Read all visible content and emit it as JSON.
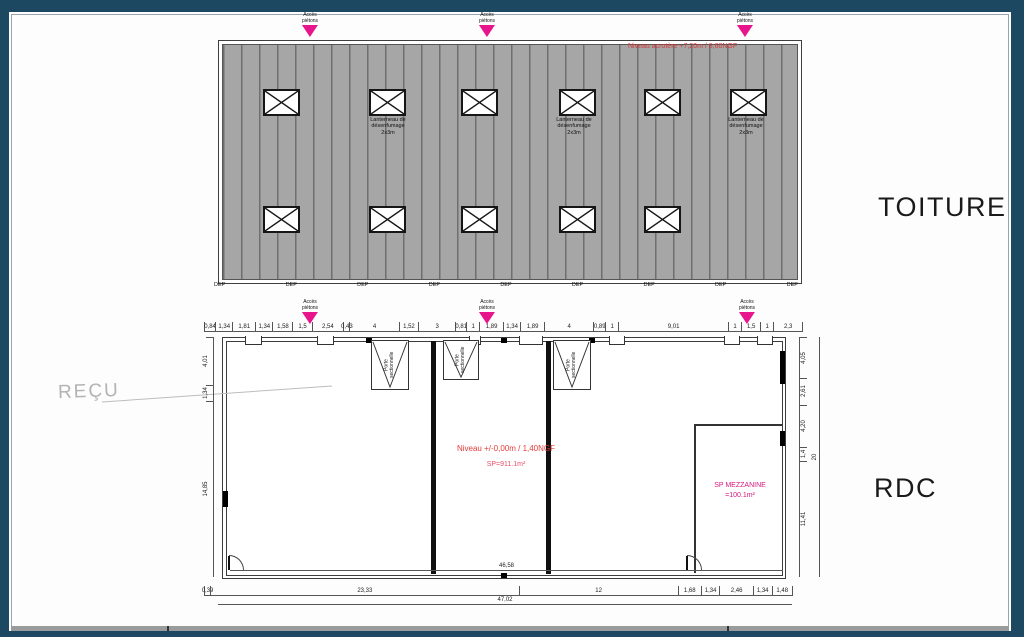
{
  "labels": {
    "toiture": "TOITURE",
    "rdc": "RDC",
    "watermark": "REÇU"
  },
  "roof": {
    "acroterre_note": "Niveau acrotère +7,20m / 8,60NGF",
    "skylight_label": "Lanterneau de\ndésenfumage\n2x3m",
    "dep_labels": [
      "DEP",
      "DEP",
      "DEP",
      "DEP",
      "DEP",
      "DEP",
      "DEP",
      "DEP",
      "DEP"
    ],
    "access_label": "Accès\npiétons"
  },
  "rdc": {
    "level_note": "Niveau +/-0,00m / 1,40NGF",
    "surface_note": "SP=911.1m²",
    "mezzanine_line1": "SP MEZZANINE",
    "mezzanine_line2": "=100.1m²",
    "door_label": "Porte\nsectionnelle"
  },
  "dims": {
    "top": [
      "0,84",
      "1,34",
      "1,81",
      "1,34",
      "1,58",
      "1,5",
      "2,54",
      "0,43",
      "4",
      "1,52",
      "3",
      "0,81",
      "1",
      "1,89",
      "1,34",
      "1,89",
      "4",
      "0,89",
      "1",
      "9,01",
      "1",
      "1,5",
      "1",
      "2,3"
    ],
    "left": [
      "4,01",
      "1,34",
      "14,85"
    ],
    "right_inner": [
      "4,05",
      "2,61",
      "4,20",
      "1,4",
      "11,41"
    ],
    "right_total": "20",
    "bottom_inner": "46,58",
    "bottom": [
      "0,39",
      "23,33",
      "12",
      "1,68",
      "1,34",
      "2,46",
      "1,34",
      "1,48"
    ],
    "bottom_total": "47,02"
  },
  "colors": {
    "frame_navy": "#1c4961",
    "roof_gray": "#a6a6a6",
    "roof_stripe": "#6f6f6f",
    "accent_pink": "#e8148c",
    "note_red": "#e63a3a",
    "note_magenta": "#d4187c"
  }
}
